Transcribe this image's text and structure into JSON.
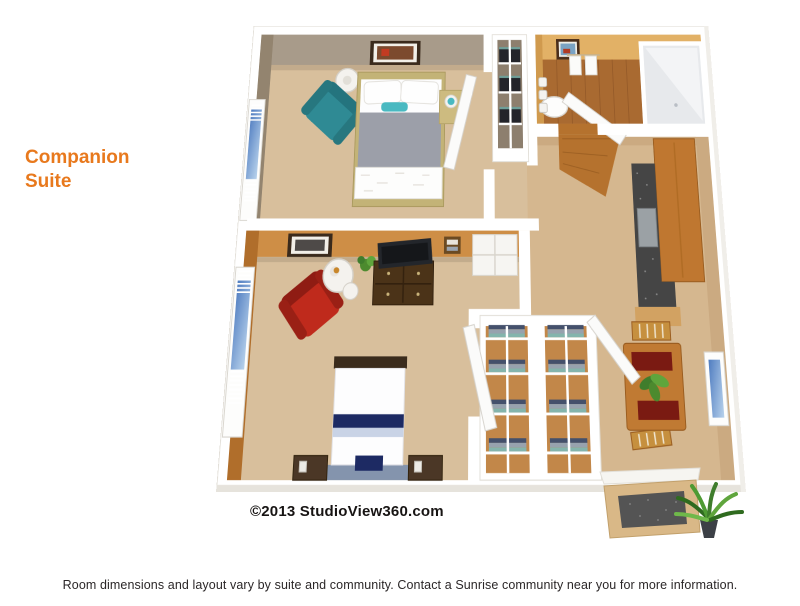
{
  "page": {
    "title": "Companion Suite",
    "copyright": "©2013 StudioView360.com",
    "caption": "Room dimensions and layout vary by suite and community. Contact a Sunrise community near you for more information."
  },
  "floorplan": {
    "description": "3D overhead floor plan rendering of a two-bedroom companion suite with shared bathroom, closets, kitchenette counter and dining area"
  },
  "colors": {
    "accent_orange": "#E8791D",
    "text_dark": "#2B2728",
    "wall_white": "#FFFFFF",
    "wall_edge": "#DDD9D1",
    "bedroom1_wall": "#A89B8A",
    "bedroom1_wall_dark": "#93846F",
    "bedroom2_wall": "#CE8E46",
    "bedroom2_wall_dark": "#B06E2B",
    "bath_wall": "#E2B166",
    "bath_wall_dark": "#D09A4E",
    "bath_floor": "#A96A31",
    "hall_wall": "#CBAA81",
    "carpet": "#D8BF9C",
    "carpet_hall": "#D5B78F",
    "wood_entry": "#B5722E",
    "teal_chair": "#2F8A94",
    "teal_light": "#49B9C1",
    "red_chair": "#BF2A1C",
    "red_chair_dark": "#8F1C13",
    "navy": "#1D2A63",
    "bed_gray": "#9C9FA9",
    "wood_frame": "#C3B377",
    "dark_wood": "#4B3318",
    "tv_black": "#23262B",
    "cabinet_wood": "#BF7730",
    "counter_dark": "#454545",
    "appliance_gray": "#9BA1A5",
    "table_wood": "#C07A33",
    "placemat_red": "#7A1A12",
    "plant_green": "#3F7D2C",
    "plant_green_light": "#5FA53C",
    "glass_blue": "#4F7CC0",
    "rug_blue": "#8494AD",
    "closet_dark_bin": "#23242A",
    "shelf_navy": "#44506B",
    "shelf_gray": "#97A2AE",
    "shelf_teal": "#84B4AC"
  }
}
